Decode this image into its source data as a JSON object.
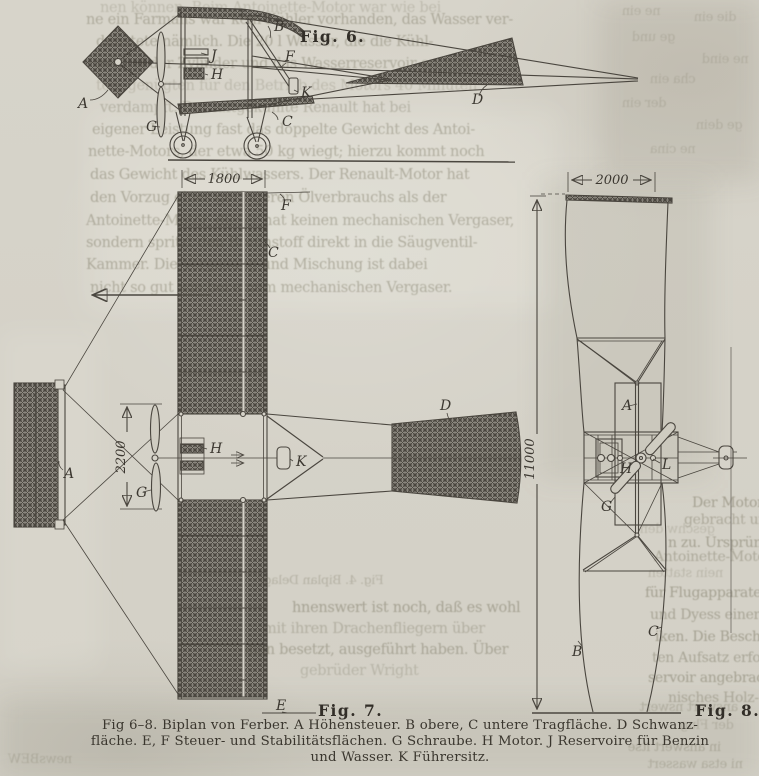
{
  "figures": {
    "fig6": {
      "title": "Fig. 6.",
      "labels": {
        "A": "A",
        "B": "B",
        "C": "C",
        "D": "D",
        "F": "F",
        "G": "G",
        "H": "H",
        "J": "J",
        "K": "K"
      }
    },
    "fig7": {
      "title": "Fig. 7.",
      "labels": {
        "A": "A",
        "C": "C",
        "D": "D",
        "E": "E",
        "F": "F",
        "G": "G",
        "H": "H",
        "K": "K"
      },
      "dims": {
        "chord": "1800",
        "prop": "2200"
      }
    },
    "fig8": {
      "title": "Fig. 8.",
      "labels": {
        "A": "A",
        "B": "B",
        "C": "C",
        "G": "G",
        "H": "H",
        "L": "L"
      },
      "dims": {
        "chord": "2000",
        "span": "11000"
      }
    }
  },
  "caption": {
    "line1": "Fig 6–8.  Biplan von Ferber.  A Höhensteuer.  B obere, C untere Tragfläche.  D Schwanz-",
    "line2": "fläche.  E, F Steuer- und Stabilitätsflächen.  G Schraube.  H Motor.  J Reservoire für Benzin",
    "line3": "und Wasser.  K Führersitz."
  },
  "bleed": [
    {
      "t": "nen können. Beim Antoinette-Motor war wie bei",
      "x": 100,
      "y": 0,
      "o": 0.3
    },
    {
      "t": "ne ein Farmans war kein Kühler vorhanden, das Wasser ver-",
      "x": 86,
      "y": 12,
      "o": 0.5
    },
    {
      "t": "dunstete nämlich. Die 20 l Wasser, die die Kühl-",
      "x": 96,
      "y": 34,
      "o": 0.5
    },
    {
      "t": "mäntel der Zylinder und das Wasserreservoir enthiel-",
      "x": 96,
      "y": 56,
      "o": 0.48
    },
    {
      "t": "ten, genügten für den Betrieb des Motors 40 Minuten",
      "x": 96,
      "y": 78,
      "o": 0.3
    },
    {
      "t": "verdampft. Der luftgekühlte Renault hat bei",
      "x": 100,
      "y": 100,
      "o": 0.42
    },
    {
      "t": "eigener Leistung fast das doppelte Gewicht des Antoi-",
      "x": 92,
      "y": 122,
      "o": 0.5
    },
    {
      "t": "nette-Motors, der etwa 50 kg wiegt; hierzu kommt noch",
      "x": 88,
      "y": 144,
      "o": 0.5
    },
    {
      "t": "das Gewicht des Kühlwassers. Der Renault-Motor hat",
      "x": 90,
      "y": 167,
      "o": 0.52
    },
    {
      "t": "den Vorzug eines geringeren Ölverbrauchs als der",
      "x": 90,
      "y": 190,
      "o": 0.52
    },
    {
      "t": "Antoinette-Motor, dieser hat keinen mechanischen Vergaser,",
      "x": 86,
      "y": 213,
      "o": 0.5
    },
    {
      "t": "sondern spritzt den Brennstoff direkt in die Säugventil-",
      "x": 86,
      "y": 235,
      "o": 0.52
    },
    {
      "t": "Kammer. Die Vergasung und Mischung ist dabei",
      "x": 86,
      "y": 257,
      "o": 0.52
    },
    {
      "t": "nicht so gut wie bei einem mechanischen Vergaser.",
      "x": 90,
      "y": 280,
      "o": 0.5
    },
    {
      "t": "ne ein",
      "x": 622,
      "y": 4,
      "mir": 1,
      "o": 0.3,
      "s": 13
    },
    {
      "t": "die ein",
      "x": 694,
      "y": 10,
      "mir": 1,
      "o": 0.3,
      "s": 13
    },
    {
      "t": "ge und",
      "x": 632,
      "y": 30,
      "mir": 1,
      "o": 0.3,
      "s": 13
    },
    {
      "t": "ne eind",
      "x": 702,
      "y": 52,
      "mir": 1,
      "o": 0.3,
      "s": 13
    },
    {
      "t": "cha ein",
      "x": 650,
      "y": 72,
      "mir": 1,
      "o": 0.3,
      "s": 13
    },
    {
      "t": "der ein",
      "x": 622,
      "y": 96,
      "mir": 1,
      "o": 0.3,
      "s": 13
    },
    {
      "t": "ge dein",
      "x": 696,
      "y": 118,
      "mir": 1,
      "o": 0.3,
      "s": 13
    },
    {
      "t": "ne cina",
      "x": 650,
      "y": 142,
      "mir": 1,
      "o": 0.3,
      "s": 13
    },
    {
      "t": "Der Motor ist im",
      "x": 692,
      "y": 495,
      "o": 0.6,
      "s": 14
    },
    {
      "t": "gebracht und er",
      "x": 684,
      "y": 512,
      "o": 0.5,
      "s": 14
    },
    {
      "t": "n zu. Ursprünglich",
      "x": 668,
      "y": 535,
      "o": 0.6,
      "s": 14
    },
    {
      "t": "Antoinette-Motor",
      "x": 654,
      "y": 549,
      "o": 0.5,
      "s": 14
    },
    {
      "t": "für Flugapparate kon-",
      "x": 645,
      "y": 585,
      "o": 0.6,
      "s": 14
    },
    {
      "t": "und Dyess einer der",
      "x": 650,
      "y": 607,
      "o": 0.55,
      "s": 14
    },
    {
      "t": "iken. Die Beschrei-",
      "x": 655,
      "y": 629,
      "o": 0.6,
      "s": 14
    },
    {
      "t": "ten Aufsatz erfolgen:",
      "x": 652,
      "y": 650,
      "o": 0.55,
      "s": 14
    },
    {
      "t": "servoir angebracht.",
      "x": 648,
      "y": 670,
      "o": 0.6,
      "s": 14
    },
    {
      "t": "nisches Holz-",
      "x": 668,
      "y": 690,
      "o": 0.5,
      "s": 14
    },
    {
      "t": "geschw den",
      "x": 640,
      "y": 522,
      "mir": 1,
      "o": 0.3,
      "s": 13
    },
    {
      "t": "nein statten",
      "x": 648,
      "y": 566,
      "mir": 1,
      "o": 0.32,
      "s": 13
    },
    {
      "t": "Fig. 4. Biplan Delagr",
      "x": 258,
      "y": 572,
      "mir": 1,
      "o": 0.4,
      "s": 12.5
    },
    {
      "t": "hnenswert ist noch, daß es wohl",
      "x": 292,
      "y": 600,
      "o": 0.58
    },
    {
      "t": "mit ihren Drachenfliegern über",
      "x": 263,
      "y": 621,
      "o": 0.42
    },
    {
      "t": "onen besetzt, ausgeführt haben. Über",
      "x": 240,
      "y": 642,
      "o": 0.55
    },
    {
      "t": "gebrüder Wright",
      "x": 300,
      "y": 663,
      "o": 0.35
    },
    {
      "t": "answert nswert",
      "x": 640,
      "y": 700,
      "mir": 1,
      "o": 0.4,
      "s": 13
    },
    {
      "t": "der Flug",
      "x": 680,
      "y": 718,
      "mir": 1,
      "o": 0.35,
      "s": 13
    },
    {
      "t": "in answert itse",
      "x": 628,
      "y": 740,
      "mir": 1,
      "o": 0.45,
      "s": 13
    },
    {
      "t": "ni etsa wassert",
      "x": 648,
      "y": 757,
      "mir": 1,
      "o": 0.4,
      "s": 13
    },
    {
      "t": "newsBEW",
      "x": 8,
      "y": 752,
      "mir": 1,
      "o": 0.35,
      "s": 13
    }
  ]
}
